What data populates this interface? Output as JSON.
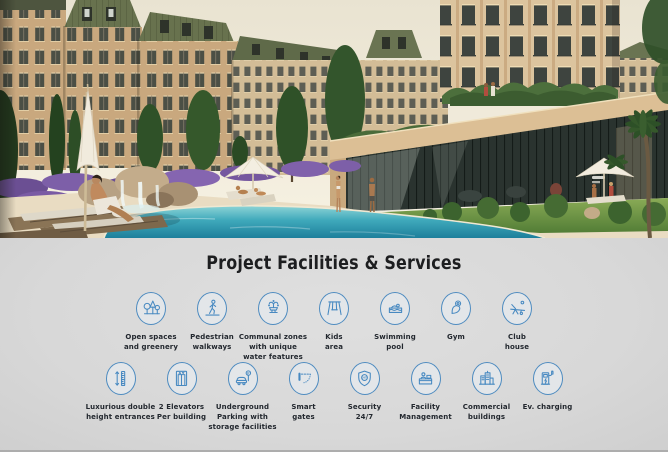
{
  "facilities": {
    "title": "Project Facilities & Services",
    "row1": [
      {
        "icon": "trees-icon",
        "label": "Open spaces\nand greenery"
      },
      {
        "icon": "pedestrian-icon",
        "label": "Pedestrian\nwalkways"
      },
      {
        "icon": "fountain-icon",
        "label": "Communal zones\nwith unique\nwater features"
      },
      {
        "icon": "swing-icon",
        "label": "Kids\narea"
      },
      {
        "icon": "swimmer-icon",
        "label": "Swimming\npool"
      },
      {
        "icon": "gym-icon",
        "label": "Gym"
      },
      {
        "icon": "lounger-icon",
        "label": "Club\nhouse"
      }
    ],
    "row2": [
      {
        "icon": "double-height-icon",
        "label": "Luxurious double\nheight entrances"
      },
      {
        "icon": "elevator-icon",
        "label": "2 Elevators\nPer building"
      },
      {
        "icon": "parking-icon",
        "label": "Underground\nParking with\nstorage facilities"
      },
      {
        "icon": "gate-icon",
        "label": "Smart\ngates"
      },
      {
        "icon": "shield-icon",
        "label": "Security\n24/7"
      },
      {
        "icon": "reception-icon",
        "label": "Facility\nManagement"
      },
      {
        "icon": "buildings-icon",
        "label": "Commercial\nbuildings"
      },
      {
        "icon": "ev-charger-icon",
        "label": "Ev. charging"
      }
    ],
    "icon_texts": {
      "parking_sign": "P",
      "security_badge": "24/7"
    }
  },
  "colors": {
    "accent_blue": "#4789c1",
    "section_background": "#d8d8d8",
    "title_color": "#1d1e20",
    "label_color": "#23282f"
  }
}
